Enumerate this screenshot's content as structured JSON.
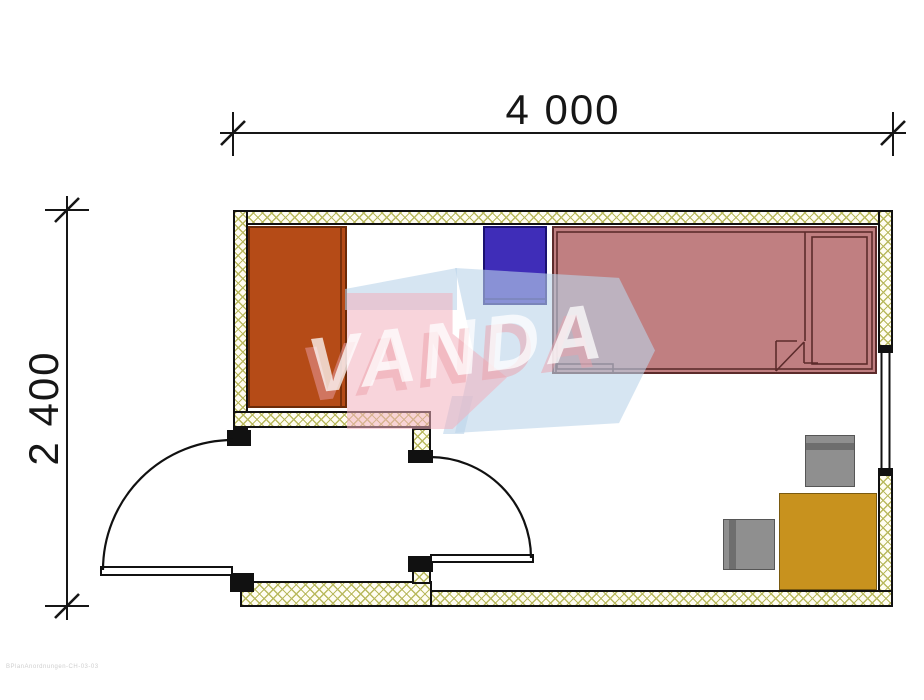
{
  "dimensions": {
    "width_label": "4 000",
    "height_label": "2 400"
  },
  "watermark": {
    "text": "VANDA",
    "arrow_blue_color": "#bad4e9",
    "arrow_pink_color": "#f3b0bd"
  },
  "footer": {
    "note": "BPlanAnordnungen-CH-03-03"
  },
  "plan": {
    "wall_hatch_color": "#b9b95e",
    "outline_color": "#111111",
    "furniture_colors": {
      "wardrobe": "#b54b17",
      "nightstand": "#3f2db8",
      "bed": "#c07f81",
      "desk": "#c8921e",
      "chairs": "#8f8f8f"
    }
  }
}
